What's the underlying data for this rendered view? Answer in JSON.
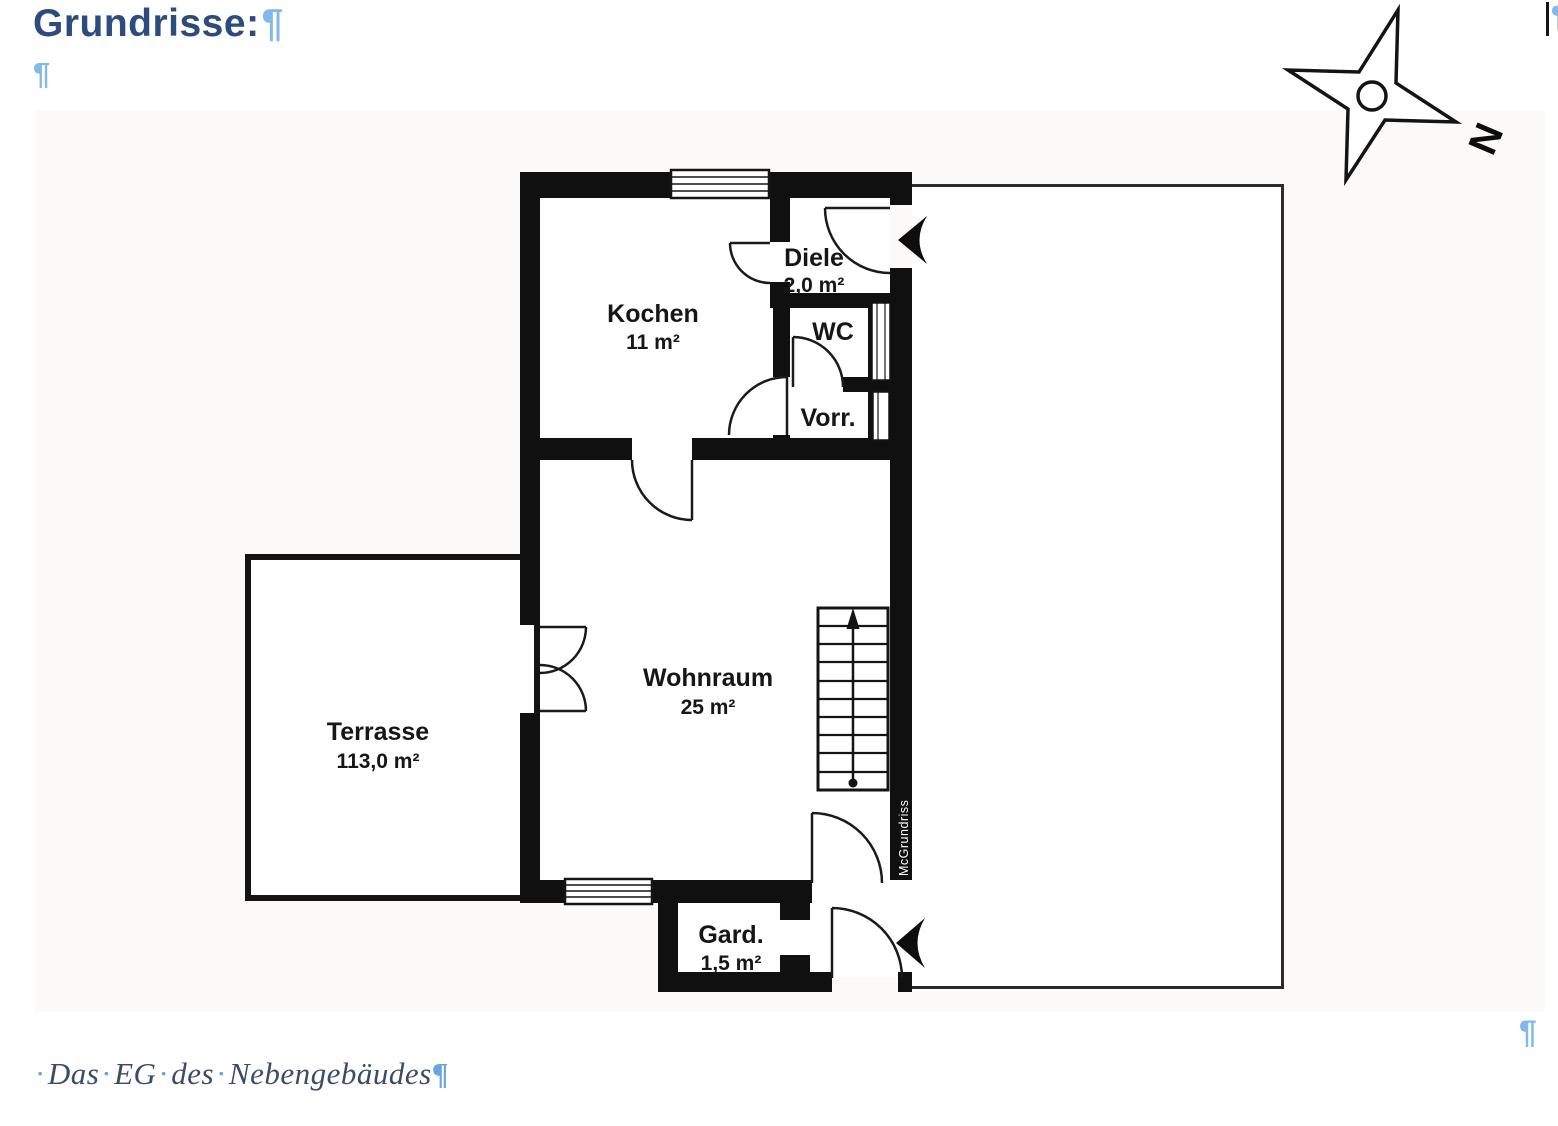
{
  "document": {
    "heading": "Grundrisse:",
    "pilcrow": "¶",
    "empty_paragraph_pilcrow": "¶",
    "caption": {
      "dot": "·",
      "word1": "Das",
      "word2": "EG",
      "word3": "des",
      "word4": "Nebengebäudes",
      "pilcrow": "¶"
    },
    "trailing_pilcrow_top_right": "¶",
    "trailing_pilcrow_bottom_right": "¶"
  },
  "floor_plan": {
    "rooms": {
      "kochen": {
        "name": "Kochen",
        "area": "11 m²"
      },
      "diele": {
        "name": "Diele",
        "area": "2,0 m²"
      },
      "wc": {
        "name": "WC"
      },
      "vorrat": {
        "name": "Vorr."
      },
      "wohnraum": {
        "name": "Wohnraum",
        "area": "25 m²"
      },
      "terrasse": {
        "name": "Terrasse",
        "area": "113,0 m²"
      },
      "garderobe": {
        "name": "Gard.",
        "area": "1,5 m²"
      }
    },
    "compass_label": "N",
    "watermark": "McGrundriss",
    "colors": {
      "wall": "#101010",
      "heading_blue": "#2d4c7c",
      "formatting_mark_blue": "#82b8ec",
      "caption_text": "#3d4c66",
      "caption_mark_blue": "#6aa3dd"
    }
  }
}
